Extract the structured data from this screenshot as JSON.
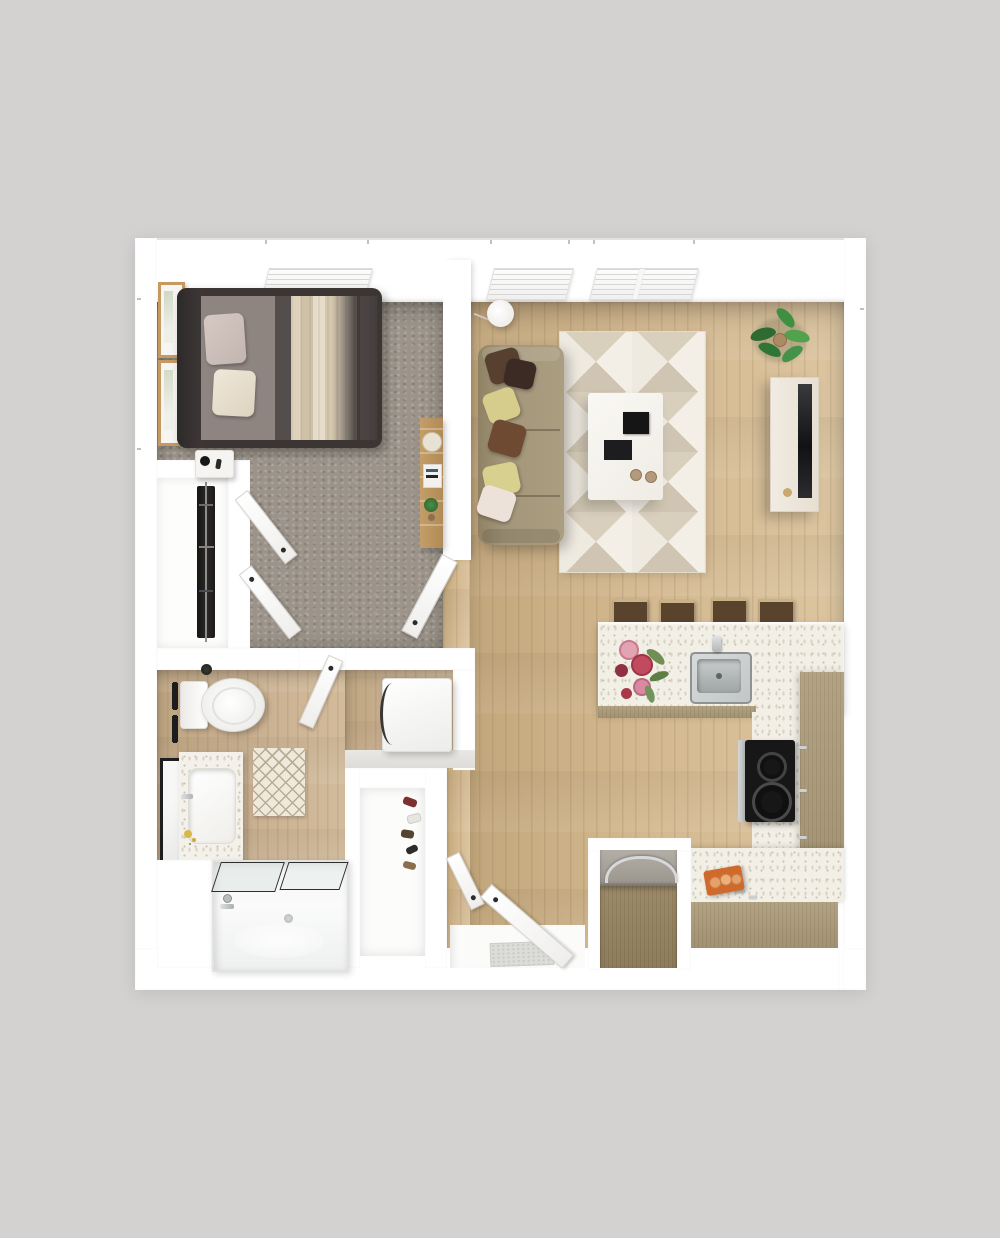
{
  "scene": {
    "type": "3d-floor-plan-top-down-render",
    "unit": "one-bedroom one-bath apartment",
    "background": "#d3d2d1"
  },
  "palette": {
    "wall": "#ffffff",
    "wall_edge": "#e7e5e2",
    "wood_floor": "#d3b88f",
    "bath_floor": "#c9b091",
    "carpet": "#9c948a",
    "cabinet_wood": "#b3a383",
    "fridge_wood": "#9c8a68",
    "countertop": "#f2efe6",
    "rug_light": "#f3efe7",
    "rug_dark": "#cfc5b2",
    "sofa": "#a3967a",
    "bed_frame": "#3b3534",
    "bed_duvet": "#443e3d",
    "bed_blanket": "#ddd2bd",
    "pillow_yellow": "#d6cd8c",
    "pillow_brown": "#57402f",
    "appliance_black": "#171717",
    "steel": "#c3c6c7",
    "plant_green": "#3c7d3c",
    "stool_seat": "#5a432d",
    "accent_orange": "#cf6a2c",
    "door_white": "#fbfbfa",
    "mat_gray": "#dcdcd8"
  },
  "rooms": [
    {
      "id": "bedroom",
      "floor": "carpet",
      "features": [
        "bed",
        "nightstand",
        "two-wall-frames",
        "ladder-shelf",
        "window",
        "reach-in-closet"
      ]
    },
    {
      "id": "closet",
      "floor": "white",
      "features": [
        "hanging-clothes",
        "double-swing-doors"
      ]
    },
    {
      "id": "living-room",
      "floor": "hardwood",
      "features": [
        "sofa",
        "six-throw-pillows",
        "geometric-rug",
        "coffee-table",
        "floor-lamp",
        "potted-plant",
        "tv-console",
        "two-windows"
      ]
    },
    {
      "id": "kitchen",
      "floor": "hardwood",
      "features": [
        "island-with-sink",
        "four-bar-stools",
        "cooktop",
        "l-shaped-counter",
        "refrigerator",
        "cutting-board"
      ]
    },
    {
      "id": "bathroom",
      "floor": "wood-tile",
      "features": [
        "toilet",
        "towel-bars",
        "vanity-sink",
        "leaning-mirror",
        "bath-mat",
        "tub-shower",
        "washer"
      ]
    },
    {
      "id": "entry",
      "floor": "hardwood",
      "features": [
        "entry-door",
        "door-mat",
        "shoe-closet"
      ]
    }
  ],
  "counts": {
    "bar_stools": 4,
    "throw_pillows": 6,
    "top_wall_windows": 3,
    "wall_frames": 2,
    "interior_door_leaves": 5
  }
}
